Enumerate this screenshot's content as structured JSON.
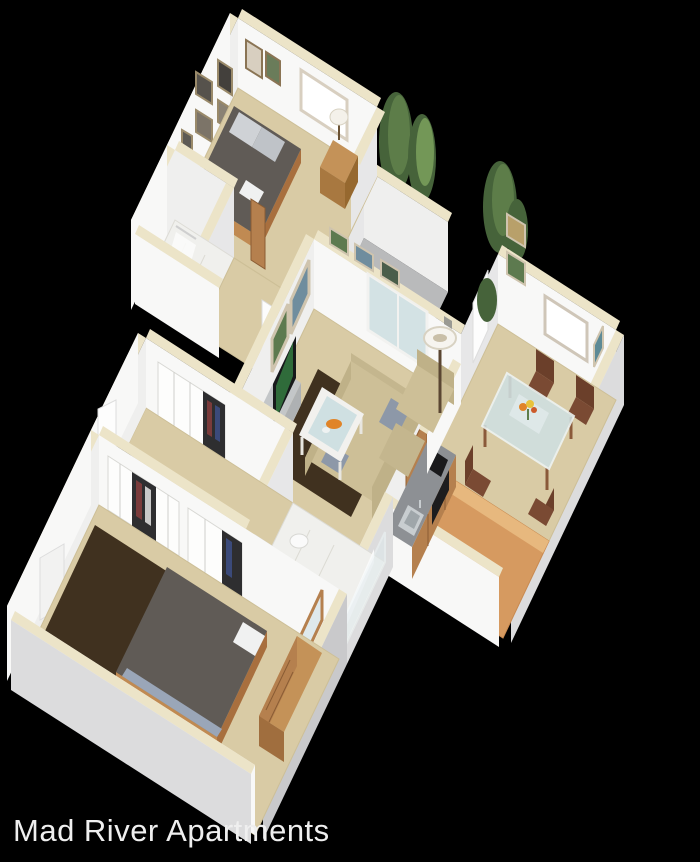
{
  "caption": {
    "text": "Mad River Apartments"
  },
  "palette": {
    "background": "#000000",
    "text": "#efefef",
    "wall_light": "#f8f8f7",
    "wall_mid": "#efefee",
    "wall_shade": "#e7e7e8",
    "wall_ext": "#dcdcdd",
    "wall_ext_dark": "#c9c9cb",
    "wall_cap": "#ece4c8",
    "carpet": "#d9cba5",
    "carpet_light": "#e2d6b4",
    "tile": "#f0f0ed",
    "wood_floor": "#d69a60",
    "wood_light": "#e7b87e",
    "cabinet_wood": "#b5804e",
    "cabinet_dark": "#a06e3e",
    "counter": "#8d9094",
    "rug": "#40311f",
    "bed_duvet": "#605b56",
    "bed_frame": "#c08a52",
    "pillow": "#cfd2d6",
    "white_linen": "#f0f1f1",
    "blanket": "#9aa6b8",
    "sofa": "#cdbf97",
    "sofa_shade": "#bfb188",
    "sofa_dark": "#c4b68e",
    "glass": "#cfe0e2",
    "mirror": "#dfe9ec",
    "tv_dark": "#17191b",
    "tv_screen": "#2f6b3a",
    "tree_dark": "#46633a",
    "tree_light": "#5d7d49",
    "tree_lighter": "#739757",
    "art_green": "#5d7a4f",
    "art_blue": "#6f8d9e",
    "art_rust": "#b0623a",
    "wood_chair": "#7a4a33",
    "wood_chair_dark": "#6b3f2a",
    "flower_orange": "#e08428",
    "flower_yellow": "#e8c23a",
    "closet_gap": "#2e2e30",
    "oven": "#1c1c1e",
    "sink": "#c8cdd0",
    "arrow": "#0a0a0a"
  },
  "scene": {
    "type": "isometric-3d-floorplan-render",
    "rooms": [
      "bedroom-1",
      "bathroom-1",
      "hallway",
      "living-room",
      "patio",
      "dining-room",
      "kitchen",
      "bathroom-2",
      "closet-hall",
      "bedroom-2"
    ],
    "icons": [
      "entry-arrow-icon"
    ]
  }
}
